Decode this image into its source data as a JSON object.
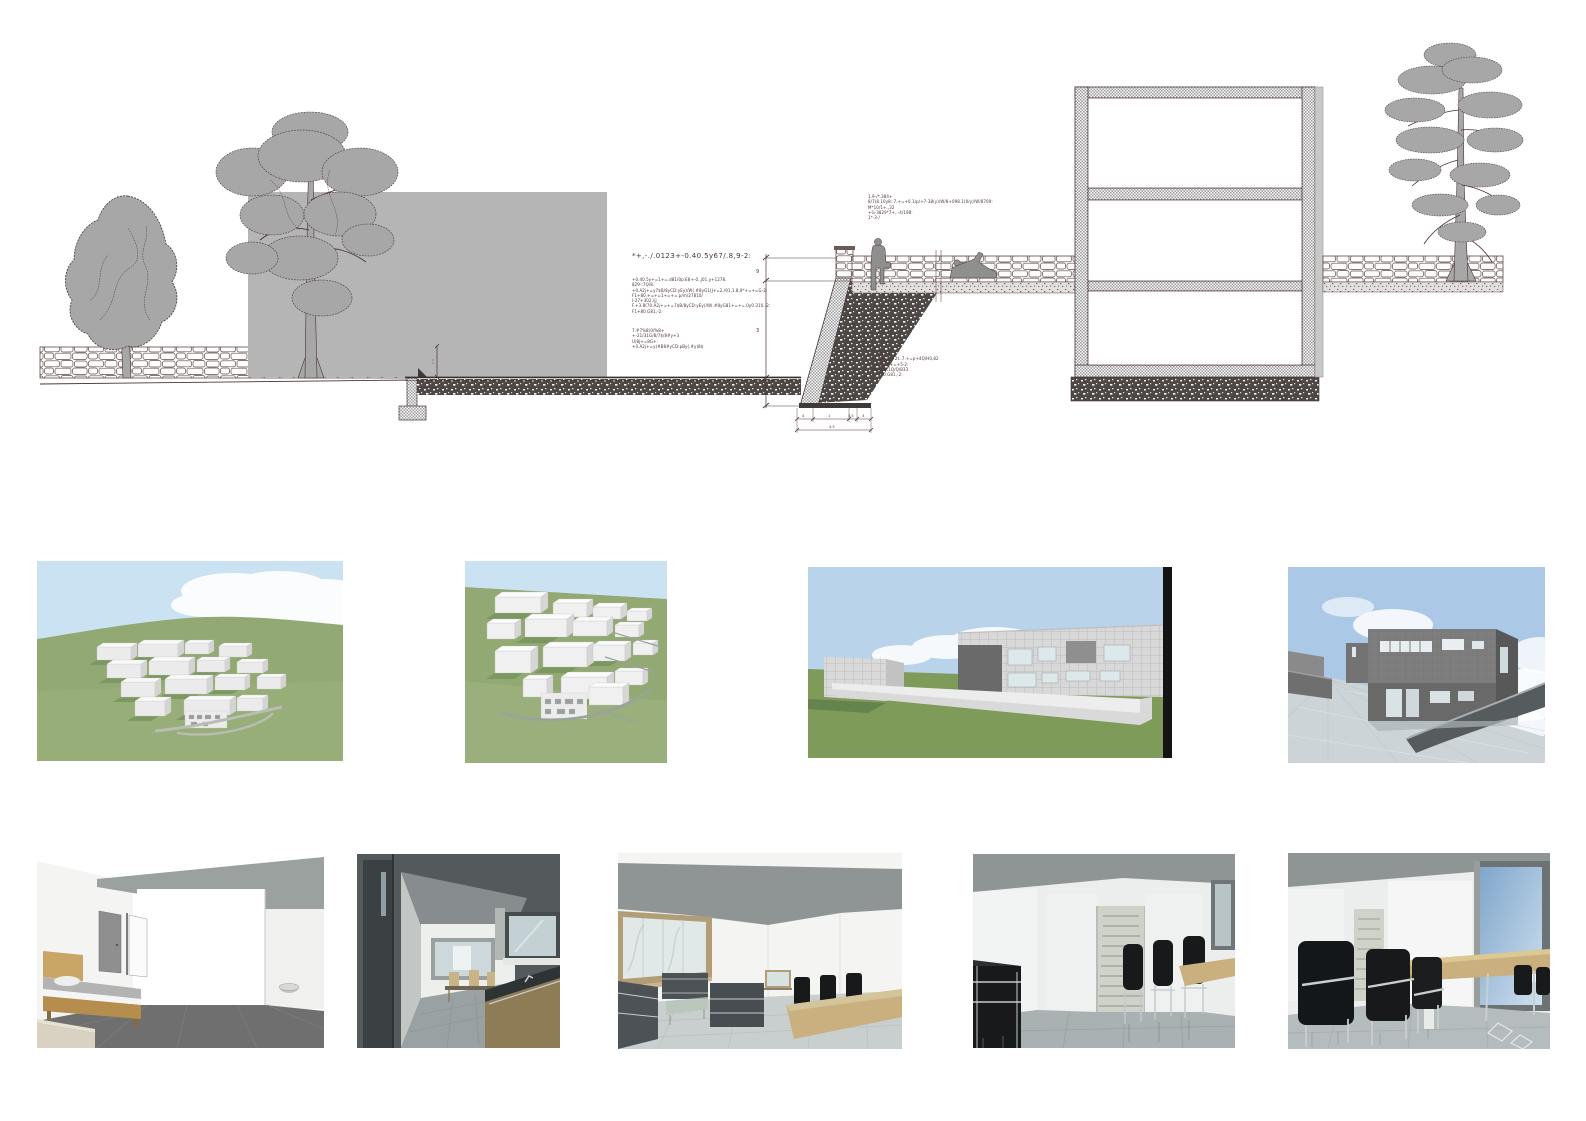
{
  "board": {
    "section": {
      "note_main": "*+,-./.0123+-0.40.5y67/.8,9-2:",
      "block_a": {
        "lines": [
          "+0.40.5y+=1+=.d81/0p:E8+-0.,j01.y+1278.",
          "829-:7Q/8.",
          "+0.A2j+=y7$B/8yCD:yEy)/W(.#8yG1(J+=2,/91,1.8,9*+=+=G-2:",
          "F1+80,+=+=1+=+=.p/m/27810/",
          "I-27+302,/jj",
          "F.+3.8(70.A2j+=+=7$B/8yCD:yEy)/W(.#8yG81+=+=.0y0.310,-2:",
          "F1+80.G81,-2:"
        ]
      },
      "block_b": {
        "lines": [
          "7.#7%8(0/%8+",
          "+-21/31G/8/7$/8#y+3",
          "U/8j+=8G+:",
          "+0.A2j+=y)#B8#yCD:pBy(.#y)8$"
        ]
      },
      "block_c": {
        "lines": [
          "1.9-/*.384+",
          "8/7(8.10y8:.7.+=+0.1/p/+7-38(y)/W/8+098.1(0/y)/W/8709:",
          "M*10/1+.,32",
          "+G-3829*7+,.-4/198:",
          "1*-3-/"
        ]
      },
      "block_d": {
        "lines": [
          "-/.#/78+",
          "F+=d+.8+2t..7.+=p+4Q/H0,82",
          "M8,0GGJ+=+5-2:",
          "M8A.8P.1Q/Q/833",
          "F1+80.G81,-2:"
        ]
      },
      "dims": {
        "height_upper": "9",
        "height_lower": "3",
        "w1": "4",
        "w2": "1",
        "w3": "3.5",
        "w4": "3",
        "w_total": "4.5"
      }
    },
    "colors": {
      "ink": "#4a3535",
      "drawing_gray": "#b5b5b5",
      "tree_fill": "#a7a7a7",
      "sky_light": "#cbe2f3",
      "sky_mid": "#b9d3eb",
      "sky_deep": "#abc9e6",
      "grass_light": "#93a973",
      "grass_dark": "#7e9b59",
      "model_white": "#ebebeb",
      "facade_dark": "#6a6a6a",
      "interior_ceiling": "#8f9594",
      "floor_dark": "#6f6f6f",
      "marble_light": "#c9cfce",
      "wood_bed": "#c9a566",
      "wood_table": "#c9b07e",
      "chair_black": "#17191b"
    }
  }
}
